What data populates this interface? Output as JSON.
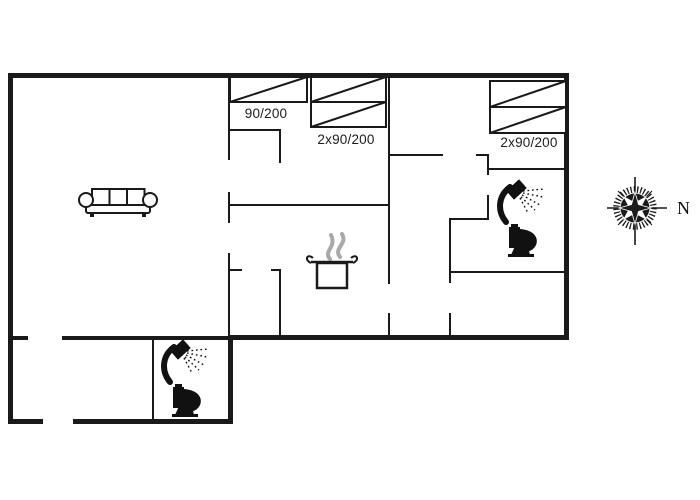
{
  "floorplan": {
    "bed_labels": [
      "90/200",
      "2x90/200",
      "2x90/200"
    ],
    "compass_label": "N",
    "wall_color": "#1a1a1a",
    "steam_color": "#a9a9a9",
    "icon_names": [
      "sofa-icon",
      "bed-icon",
      "cooking-pot-icon",
      "shower-icon",
      "toilet-icon",
      "compass-rose-icon"
    ]
  }
}
